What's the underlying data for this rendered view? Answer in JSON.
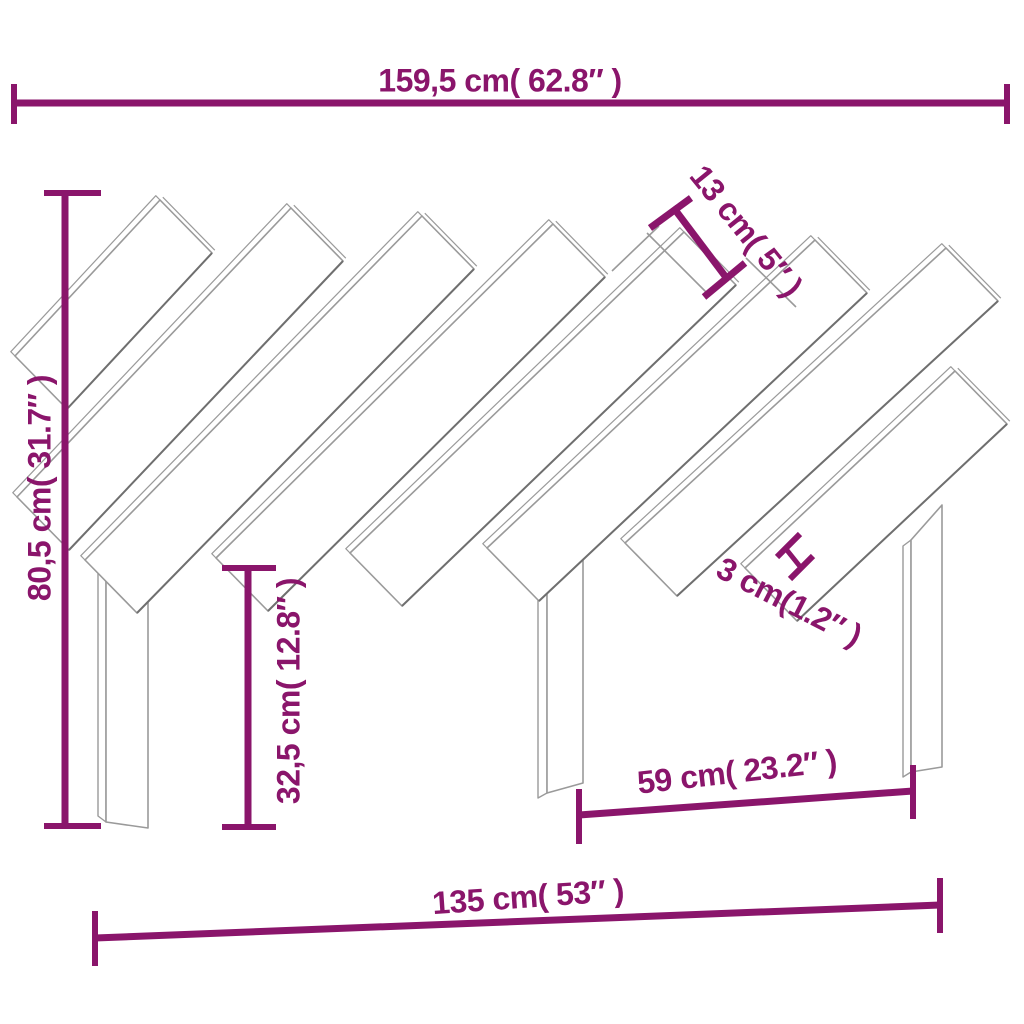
{
  "page": {
    "background": "#ffffff"
  },
  "diagram": {
    "kind": "furniture-dimension-drawing",
    "subject": "headboard with diagonal slats and three legs",
    "colors": {
      "dimension": "#8A156B",
      "outline": "#9a9a9a",
      "outline_dark": "#6f6f6f",
      "fill": "#ffffff"
    },
    "labels": {
      "overall_width": "159,5 cm( 62.8″ )",
      "overall_height": "80,5 cm( 31.7″ )",
      "leg_height": "32,5 cm( 12.8″ )",
      "slat_width": "13 cm( 5″ )",
      "slat_gap": "3 cm(1.2″ )",
      "leg_spacing": "59 cm( 23.2″ )",
      "lower_width": "135 cm( 53″ )"
    },
    "values": {
      "overall_width_cm": "159,5",
      "overall_width_in": "62.8",
      "overall_height_cm": "80,5",
      "overall_height_in": "31.7",
      "leg_height_cm": "32,5",
      "leg_height_in": "12.8",
      "slat_width_cm": "13",
      "slat_width_in": "5",
      "slat_gap_cm": "3",
      "slat_gap_in": "1.2",
      "leg_spacing_cm": "59",
      "leg_spacing_in": "23.2",
      "lower_width_cm": "135",
      "lower_width_in": "53"
    }
  }
}
